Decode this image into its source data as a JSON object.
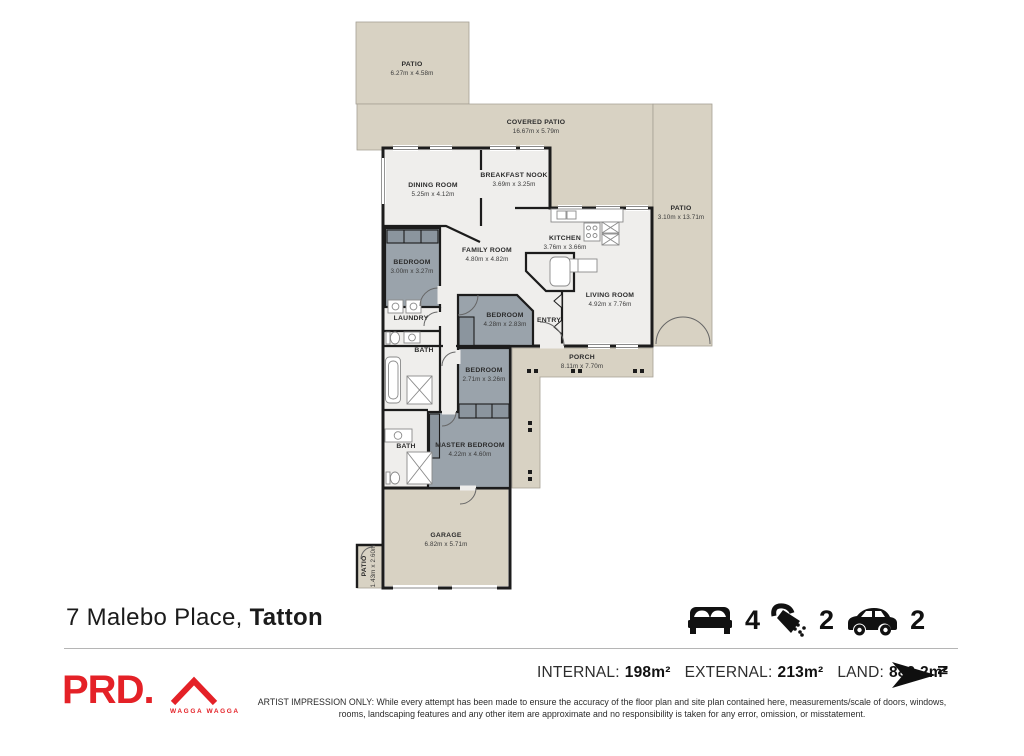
{
  "plan": {
    "colors": {
      "outdoor": "#d8d2c3",
      "interior": "#efeeec",
      "bedroom": "#9aa3ab",
      "wall": "#1c1c1c"
    },
    "rooms": [
      {
        "name": "PATIO",
        "dims": "6.27m x 4.58m"
      },
      {
        "name": "COVERED PATIO",
        "dims": "16.67m x 5.79m"
      },
      {
        "name": "PATIO",
        "dims": "3.10m x 13.71m"
      },
      {
        "name": "DINING ROOM",
        "dims": "5.25m x 4.12m"
      },
      {
        "name": "BREAKFAST NOOK",
        "dims": "3.69m x 3.25m"
      },
      {
        "name": "KITCHEN",
        "dims": "3.76m x 3.66m"
      },
      {
        "name": "FAMILY ROOM",
        "dims": "4.80m x 4.82m"
      },
      {
        "name": "LIVING ROOM",
        "dims": "4.92m x 7.76m"
      },
      {
        "name": "BEDROOM",
        "dims": "3.00m x 3.27m"
      },
      {
        "name": "LAUNDRY",
        "dims": ""
      },
      {
        "name": "BATH",
        "dims": ""
      },
      {
        "name": "BEDROOM",
        "dims": "4.28m x 2.83m"
      },
      {
        "name": "ENTRY",
        "dims": ""
      },
      {
        "name": "PORCH",
        "dims": "8.11m x 7.70m"
      },
      {
        "name": "BEDROOM",
        "dims": "2.71m x 3.26m"
      },
      {
        "name": "MASTER BEDROOM",
        "dims": "4.22m x 4.60m"
      },
      {
        "name": "BATH",
        "dims": ""
      },
      {
        "name": "GARAGE",
        "dims": "6.82m x 5.71m"
      },
      {
        "name": "PATIO",
        "dims": "1.43m x 2.60m"
      }
    ]
  },
  "footer": {
    "address": {
      "street": "7 Malebo Place,",
      "suburb": "Tatton"
    },
    "stats": {
      "beds": "4",
      "baths": "2",
      "cars": "2"
    },
    "areas": {
      "internal_label": "INTERNAL:",
      "internal": "198m²",
      "external_label": "EXTERNAL:",
      "external": "213m²",
      "land_label": "LAND:",
      "land": "880.2m²"
    },
    "logo": {
      "brand": "PRD.",
      "location": "WAGGA WAGGA"
    },
    "north": "N",
    "disclaimer": "ARTIST IMPRESSION ONLY: While every attempt has been made to ensure the accuracy of the floor plan and site plan contained here, measurements/scale of doors, windows, rooms, landscaping features and any other item are approximate and no responsibility is taken for any error, omission, or misstatement."
  }
}
